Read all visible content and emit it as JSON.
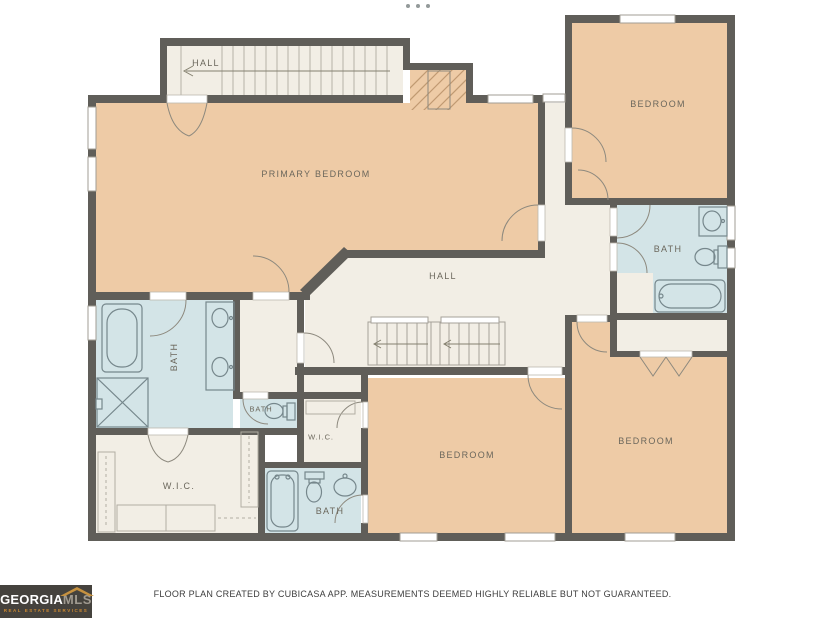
{
  "header": {
    "overflow_dots_icon": "•••"
  },
  "floor_plan": {
    "rooms": {
      "hall_upper": {
        "label": "HALL"
      },
      "primary_bedroom": {
        "label": "PRIMARY BEDROOM"
      },
      "bedroom_top_right": {
        "label": "BEDROOM"
      },
      "bath_top_right": {
        "label": "BATH"
      },
      "hall_center": {
        "label": "HALL"
      },
      "bath_primary": {
        "label": "BATH"
      },
      "bath_small": {
        "label": "BATH"
      },
      "wic_small": {
        "label": "W.I.C."
      },
      "wic_large": {
        "label": "W.I.C."
      },
      "bath_lower": {
        "label": "BATH"
      },
      "bedroom_lower_center": {
        "label": "BEDROOM"
      },
      "bedroom_lower_right": {
        "label": "BEDROOM"
      }
    },
    "colors": {
      "wall": "#605e59",
      "bedroom_fill": "#eecba6",
      "bath_fill": "#d3e4e7",
      "hall_fill": "#f2eee5",
      "label_text": "#6b675c"
    }
  },
  "footer": {
    "disclaimer": "FLOOR PLAN CREATED BY CUBICASA APP. MEASUREMENTS DEEMED HIGHLY RELIABLE BUT NOT GUARANTEED."
  },
  "logo": {
    "brand_primary": "GEORGIA",
    "brand_secondary": "MLS",
    "tagline": "REAL ESTATE SERVICES",
    "colors": {
      "background": "#45423d",
      "roof_gold": "#c6913f",
      "tagline": "#cd8931"
    }
  }
}
